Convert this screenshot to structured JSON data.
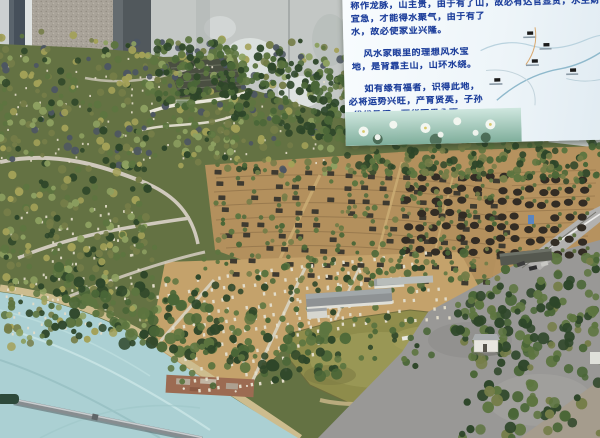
{
  "scene": {
    "description": "Indoor photograph of a physical feng-shui cemetery terrain scale model: tree-covered hills with terraced grave plots, tomb mounds, a pond, paved plaza, river water at the base, and a metal pointer rod lying across it; an explanation board with Chinese text and a site map hangs at the upper right against a weathered concrete wall."
  },
  "sign": {
    "lines": [
      "称作龙脉，山主贵，由于有了山，故必有达官显贵，水主财",
      "宜急，才能得水聚气，由于有了",
      "水，故必使家业兴隆。",
      "风水家眼里的理想风水宝",
      "地，是背靠主山，山环水绕。",
      "如有缘有福者，识得此地，",
      "必将运势兴旺，产育贤英，子孙",
      "代代昌盛，荣华富贵永享。"
    ],
    "text_color": "#1c3e9b"
  },
  "palette": {
    "wall": "#c3c7c5",
    "wall_pillar": "#a9a399",
    "wall_dark": "#51585c",
    "wall_stain": "#dfe4e2",
    "tree_dark": "#2e4629",
    "tree_green": "#4a6637",
    "tree_mid": "#5d7540",
    "tree_olive": "#757d48",
    "tree_yellow": "#a3a158",
    "tree_pale": "#8da061",
    "tomb_slate": "#4d5662",
    "stone_white": "#e2dcc9",
    "plot_dark": "#3e3a30",
    "mound_dark": "#322c24",
    "bush_green": "#5d7040",
    "road_light": "#cfc9b9",
    "ground_tan": "#b3905d",
    "ground_tan_light": "#c4a26b",
    "water": "#abd0d3",
    "pond": "#8f8d4c",
    "plaza": "#999896",
    "rod_metal": "#878d90",
    "rod_handle": "#2e4a3b"
  }
}
